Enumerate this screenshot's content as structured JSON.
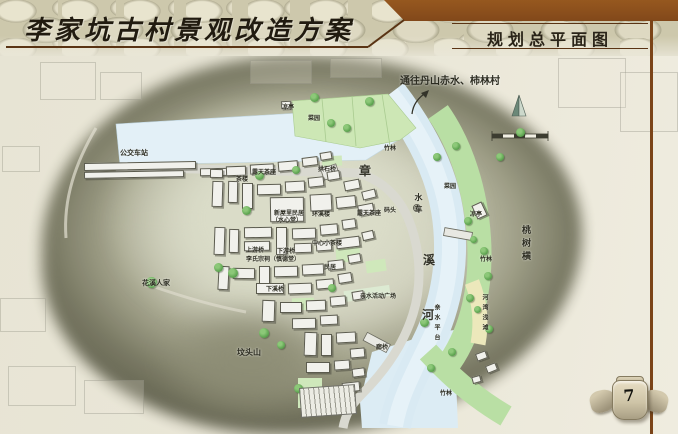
{
  "header": {
    "title": "李家坑古村景观改造方案",
    "section_title": "规划总平面图"
  },
  "page": {
    "number": "7"
  },
  "colors": {
    "brown_bar": "#8a4e20",
    "rule_brown": "#5a3414",
    "parchment": "#e8e5d6",
    "hill_dark": "#6f6f58",
    "river_blue": "#d9eaf3",
    "green_band": "#b9dfa4",
    "plot_green": "#cde7b5",
    "yellow_strip": "#ece8bb",
    "building_fill": "#f1f1ec",
    "building_edge": "#55554a",
    "tree_green": "#58a04c"
  },
  "map": {
    "direction_note": {
      "text": "通往丹山赤水、柿林村",
      "x": 400,
      "y": 72,
      "size": 10
    },
    "river_name_chars": [
      {
        "ch": "章",
        "x": 359,
        "y": 162
      },
      {
        "ch": "溪",
        "x": 423,
        "y": 251
      },
      {
        "ch": "河",
        "x": 422,
        "y": 306
      }
    ],
    "labels": [
      {
        "t": "公交车站",
        "x": 120,
        "y": 148,
        "s": 7
      },
      {
        "t": "凉亭",
        "x": 282,
        "y": 102,
        "s": 6
      },
      {
        "t": "菜园",
        "x": 308,
        "y": 113,
        "s": 6
      },
      {
        "t": "竹林",
        "x": 384,
        "y": 143,
        "s": 6
      },
      {
        "t": "菜园",
        "x": 444,
        "y": 181,
        "s": 6
      },
      {
        "t": "茶楼",
        "x": 236,
        "y": 174,
        "s": 6
      },
      {
        "t": "露天茶座",
        "x": 252,
        "y": 167,
        "s": 6
      },
      {
        "t": "拱石桥",
        "x": 318,
        "y": 164,
        "s": 6
      },
      {
        "t": "水车",
        "x": 414,
        "y": 193,
        "s": 8,
        "v": true
      },
      {
        "t": "码头",
        "x": 384,
        "y": 205,
        "s": 6
      },
      {
        "t": "露天茶座",
        "x": 357,
        "y": 208,
        "s": 6
      },
      {
        "t": "环溪楼",
        "x": 312,
        "y": 209,
        "s": 6
      },
      {
        "t": "新屋里民居",
        "x": 274,
        "y": 208,
        "s": 6
      },
      {
        "t": "（水心堂）",
        "x": 272,
        "y": 215,
        "s": 6
      },
      {
        "t": "凉亭",
        "x": 470,
        "y": 209,
        "s": 6
      },
      {
        "t": "桃树横",
        "x": 519,
        "y": 225,
        "s": 9,
        "v": true
      },
      {
        "t": "竹林",
        "x": 480,
        "y": 254,
        "s": 6
      },
      {
        "t": "上游桥",
        "x": 246,
        "y": 245,
        "s": 6
      },
      {
        "t": "下游桥",
        "x": 277,
        "y": 246,
        "s": 6
      },
      {
        "t": "李氏宗祠（慎德堂）",
        "x": 246,
        "y": 254,
        "s": 6
      },
      {
        "t": "中心小茶楼",
        "x": 312,
        "y": 238,
        "s": 6
      },
      {
        "t": "民居",
        "x": 324,
        "y": 262,
        "s": 6
      },
      {
        "t": "下溪桥",
        "x": 266,
        "y": 284,
        "s": 6
      },
      {
        "t": "花溪人家",
        "x": 142,
        "y": 278,
        "s": 7
      },
      {
        "t": "亲水活动广场",
        "x": 360,
        "y": 291,
        "s": 6
      },
      {
        "t": "亲水平台",
        "x": 432,
        "y": 304,
        "s": 6,
        "v": true
      },
      {
        "t": "河湾浅滩",
        "x": 480,
        "y": 294,
        "s": 6,
        "v": true
      },
      {
        "t": "坟头山",
        "x": 237,
        "y": 347,
        "s": 8
      },
      {
        "t": "廊桥",
        "x": 376,
        "y": 342,
        "s": 6
      },
      {
        "t": "停车场",
        "x": 328,
        "y": 400,
        "s": 6,
        "r": -8
      },
      {
        "t": "竹林",
        "x": 440,
        "y": 388,
        "s": 6
      }
    ],
    "buildings": [
      [
        84,
        162,
        112,
        8,
        -1
      ],
      [
        84,
        171,
        100,
        7,
        -1
      ],
      [
        200,
        168,
        36,
        8,
        -1
      ],
      [
        281,
        101,
        10,
        8,
        -3
      ],
      [
        210,
        169,
        13,
        9,
        1
      ],
      [
        226,
        166,
        20,
        10,
        -2
      ],
      [
        250,
        164,
        24,
        10,
        -3
      ],
      [
        278,
        161,
        20,
        10,
        -5
      ],
      [
        302,
        157,
        16,
        9,
        -7
      ],
      [
        320,
        152,
        12,
        8,
        -9
      ],
      [
        212,
        181,
        11,
        26,
        2
      ],
      [
        228,
        181,
        10,
        22,
        1
      ],
      [
        242,
        183,
        11,
        26,
        0
      ],
      [
        257,
        184,
        24,
        11,
        -1
      ],
      [
        285,
        181,
        20,
        11,
        -3
      ],
      [
        308,
        177,
        16,
        10,
        -6
      ],
      [
        327,
        171,
        13,
        9,
        -9
      ],
      [
        344,
        180,
        16,
        10,
        -11
      ],
      [
        362,
        190,
        14,
        9,
        -14
      ],
      [
        270,
        197,
        34,
        25,
        -1
      ],
      [
        310,
        194,
        22,
        17,
        -3
      ],
      [
        336,
        196,
        20,
        12,
        -6
      ],
      [
        358,
        204,
        16,
        11,
        -11
      ],
      [
        214,
        227,
        11,
        28,
        2
      ],
      [
        229,
        229,
        10,
        24,
        1
      ],
      [
        244,
        227,
        28,
        11,
        -1
      ],
      [
        244,
        241,
        26,
        10,
        -1
      ],
      [
        276,
        227,
        11,
        28,
        0
      ],
      [
        292,
        228,
        24,
        11,
        -2
      ],
      [
        320,
        224,
        18,
        11,
        -5
      ],
      [
        342,
        219,
        14,
        10,
        -8
      ],
      [
        294,
        243,
        18,
        10,
        -2
      ],
      [
        316,
        241,
        16,
        10,
        -4
      ],
      [
        336,
        237,
        24,
        11,
        -7
      ],
      [
        362,
        231,
        12,
        9,
        -13
      ],
      [
        218,
        266,
        11,
        24,
        3
      ],
      [
        233,
        268,
        22,
        11,
        1
      ],
      [
        259,
        266,
        11,
        26,
        0
      ],
      [
        274,
        266,
        24,
        11,
        -1
      ],
      [
        302,
        264,
        22,
        11,
        -3
      ],
      [
        328,
        260,
        16,
        10,
        -6
      ],
      [
        348,
        254,
        13,
        9,
        -10
      ],
      [
        256,
        283,
        28,
        11,
        0
      ],
      [
        288,
        283,
        24,
        11,
        -2
      ],
      [
        316,
        279,
        18,
        10,
        -5
      ],
      [
        338,
        273,
        14,
        10,
        -9
      ],
      [
        262,
        300,
        13,
        22,
        2
      ],
      [
        280,
        302,
        22,
        11,
        0
      ],
      [
        306,
        300,
        20,
        11,
        -2
      ],
      [
        330,
        296,
        16,
        10,
        -5
      ],
      [
        352,
        291,
        12,
        9,
        -9
      ],
      [
        292,
        318,
        24,
        11,
        -1
      ],
      [
        320,
        315,
        18,
        10,
        -3
      ],
      [
        304,
        332,
        13,
        24,
        2
      ],
      [
        321,
        334,
        11,
        22,
        0
      ],
      [
        336,
        332,
        20,
        11,
        -3
      ],
      [
        350,
        348,
        15,
        10,
        -5
      ],
      [
        306,
        362,
        24,
        11,
        0
      ],
      [
        334,
        360,
        16,
        10,
        -4
      ],
      [
        352,
        368,
        13,
        9,
        -7
      ],
      [
        342,
        382,
        18,
        10,
        -6
      ],
      [
        474,
        203,
        11,
        15,
        -25
      ],
      [
        476,
        352,
        11,
        8,
        -20
      ],
      [
        486,
        364,
        11,
        8,
        -22
      ],
      [
        472,
        376,
        9,
        7,
        -16
      ]
    ],
    "ghost_buildings": [
      [
        40,
        62,
        54,
        36
      ],
      [
        100,
        72,
        40,
        26
      ],
      [
        250,
        60,
        60,
        22
      ],
      [
        330,
        58,
        50,
        18
      ],
      [
        2,
        146,
        36,
        24
      ],
      [
        0,
        298,
        44,
        32
      ],
      [
        8,
        366,
        66,
        38
      ],
      [
        84,
        380,
        58,
        32
      ],
      [
        558,
        58,
        66,
        48
      ],
      [
        620,
        72,
        56,
        58
      ]
    ],
    "trees": [
      [
        314,
        97,
        9
      ],
      [
        369,
        101,
        9
      ],
      [
        331,
        123,
        8
      ],
      [
        347,
        128,
        8
      ],
      [
        296,
        170,
        8
      ],
      [
        259,
        175,
        9
      ],
      [
        246,
        210,
        9
      ],
      [
        218,
        267,
        9
      ],
      [
        233,
        273,
        10
      ],
      [
        151,
        282,
        11
      ],
      [
        264,
        333,
        10
      ],
      [
        332,
        288,
        8
      ],
      [
        424,
        322,
        9
      ],
      [
        470,
        298,
        8
      ],
      [
        484,
        251,
        8
      ],
      [
        468,
        221,
        8
      ],
      [
        473,
        239,
        7
      ],
      [
        500,
        157,
        8
      ],
      [
        437,
        157,
        8
      ],
      [
        456,
        146,
        8
      ],
      [
        520,
        132,
        9
      ],
      [
        488,
        276,
        8
      ],
      [
        477,
        309,
        7
      ],
      [
        489,
        329,
        8
      ],
      [
        452,
        352,
        8
      ],
      [
        431,
        368,
        8
      ],
      [
        298,
        388,
        9
      ],
      [
        281,
        345,
        8
      ]
    ]
  }
}
